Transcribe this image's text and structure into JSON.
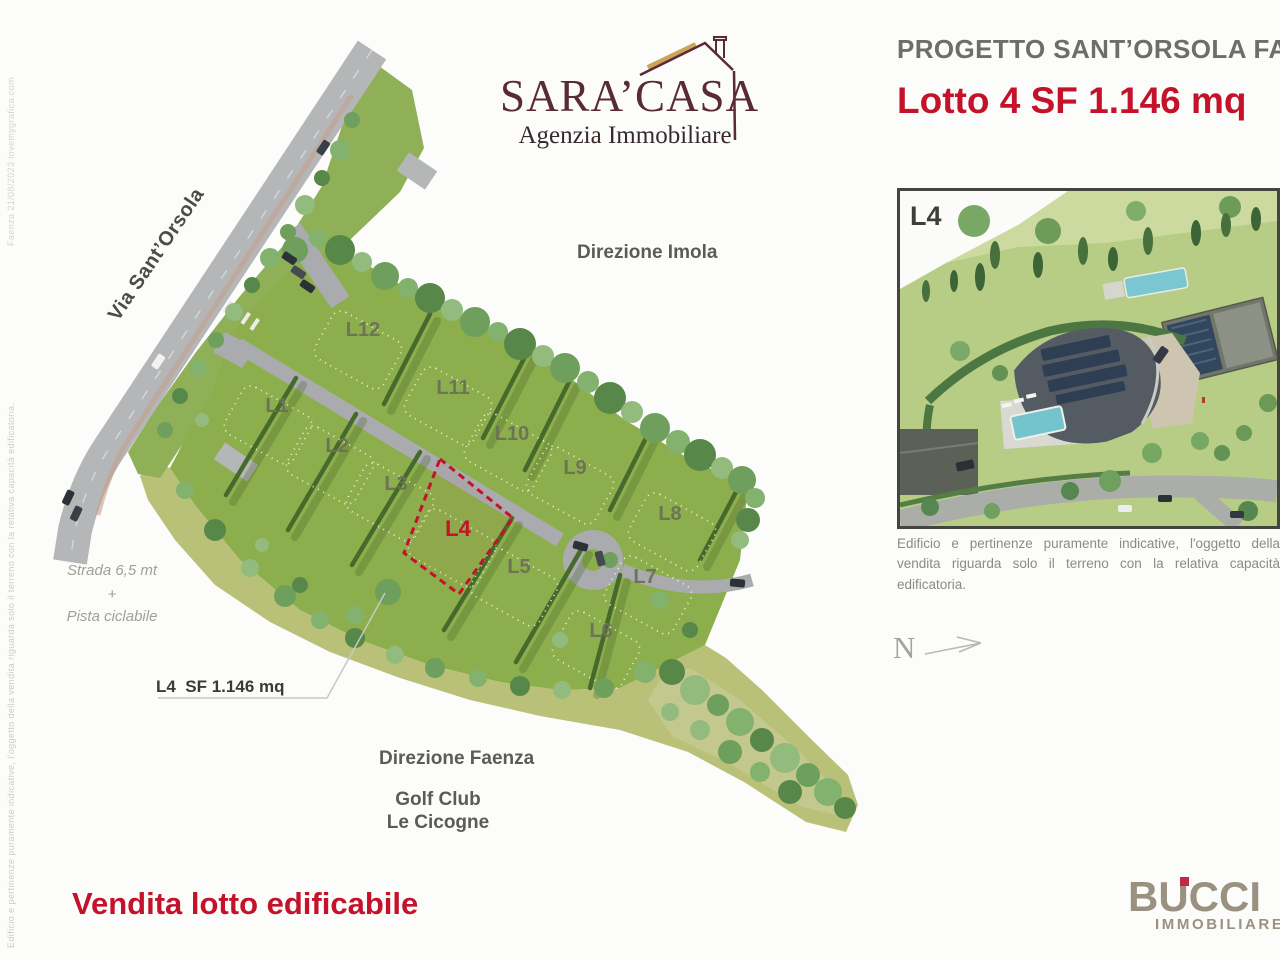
{
  "watermarks": {
    "top_vertical": "Faenza 21/08/2023   lovemygrafica.com",
    "bottom_vertical": "Edificio e pertinenze puramente indicative, l'oggetto della vendita riguarda solo il terreno con la relativa capacità edificatoria."
  },
  "logo": {
    "name": "SARA’CASA",
    "subtitle": "Agenzia Immobiliare"
  },
  "header": {
    "project": "PROGETTO SANT’ORSOLA FAENZA",
    "lot": "Lotto 4 SF 1.146 mq"
  },
  "inset": {
    "corner_label": "L4",
    "caption": "Edificio e pertinenze puramente indicative, l'oggetto della vendita riguarda solo il terreno con la relativa capacità edificatoria."
  },
  "compass": {
    "label": "N"
  },
  "map": {
    "street_label": "Via Sant’Orsola",
    "direction_top": "Direzione Imola",
    "direction_bottom": "Direzione Faenza",
    "poi_line1": "Golf Club",
    "poi_line2": "Le Cicogne",
    "road_note": {
      "line1": "Strada 6,5 mt",
      "plus": "+",
      "line2": "Pista ciclabile"
    },
    "callout": "L4  SF 1.146 mq",
    "highlighted_lot": "L4",
    "lots": [
      {
        "label": "L1"
      },
      {
        "label": "L2"
      },
      {
        "label": "L3"
      },
      {
        "label": "L4"
      },
      {
        "label": "L5"
      },
      {
        "label": "L6"
      },
      {
        "label": "L7"
      },
      {
        "label": "L8"
      },
      {
        "label": "L9"
      },
      {
        "label": "L10"
      },
      {
        "label": "L11"
      },
      {
        "label": "L12"
      }
    ]
  },
  "footer": {
    "sale": "Vendita lotto edificabile",
    "brand": "BUCCI",
    "brand_sub": "IMMOBILIARE"
  },
  "colors": {
    "accent_red": "#c3122a",
    "logo_maroon": "#5a2b36",
    "brand_taupe": "#9a9181",
    "heading_gray": "#6d6e69",
    "map_green": "#8cae4d",
    "rough_grass": "#b9c178",
    "road_gray": "#b4b6b8"
  }
}
